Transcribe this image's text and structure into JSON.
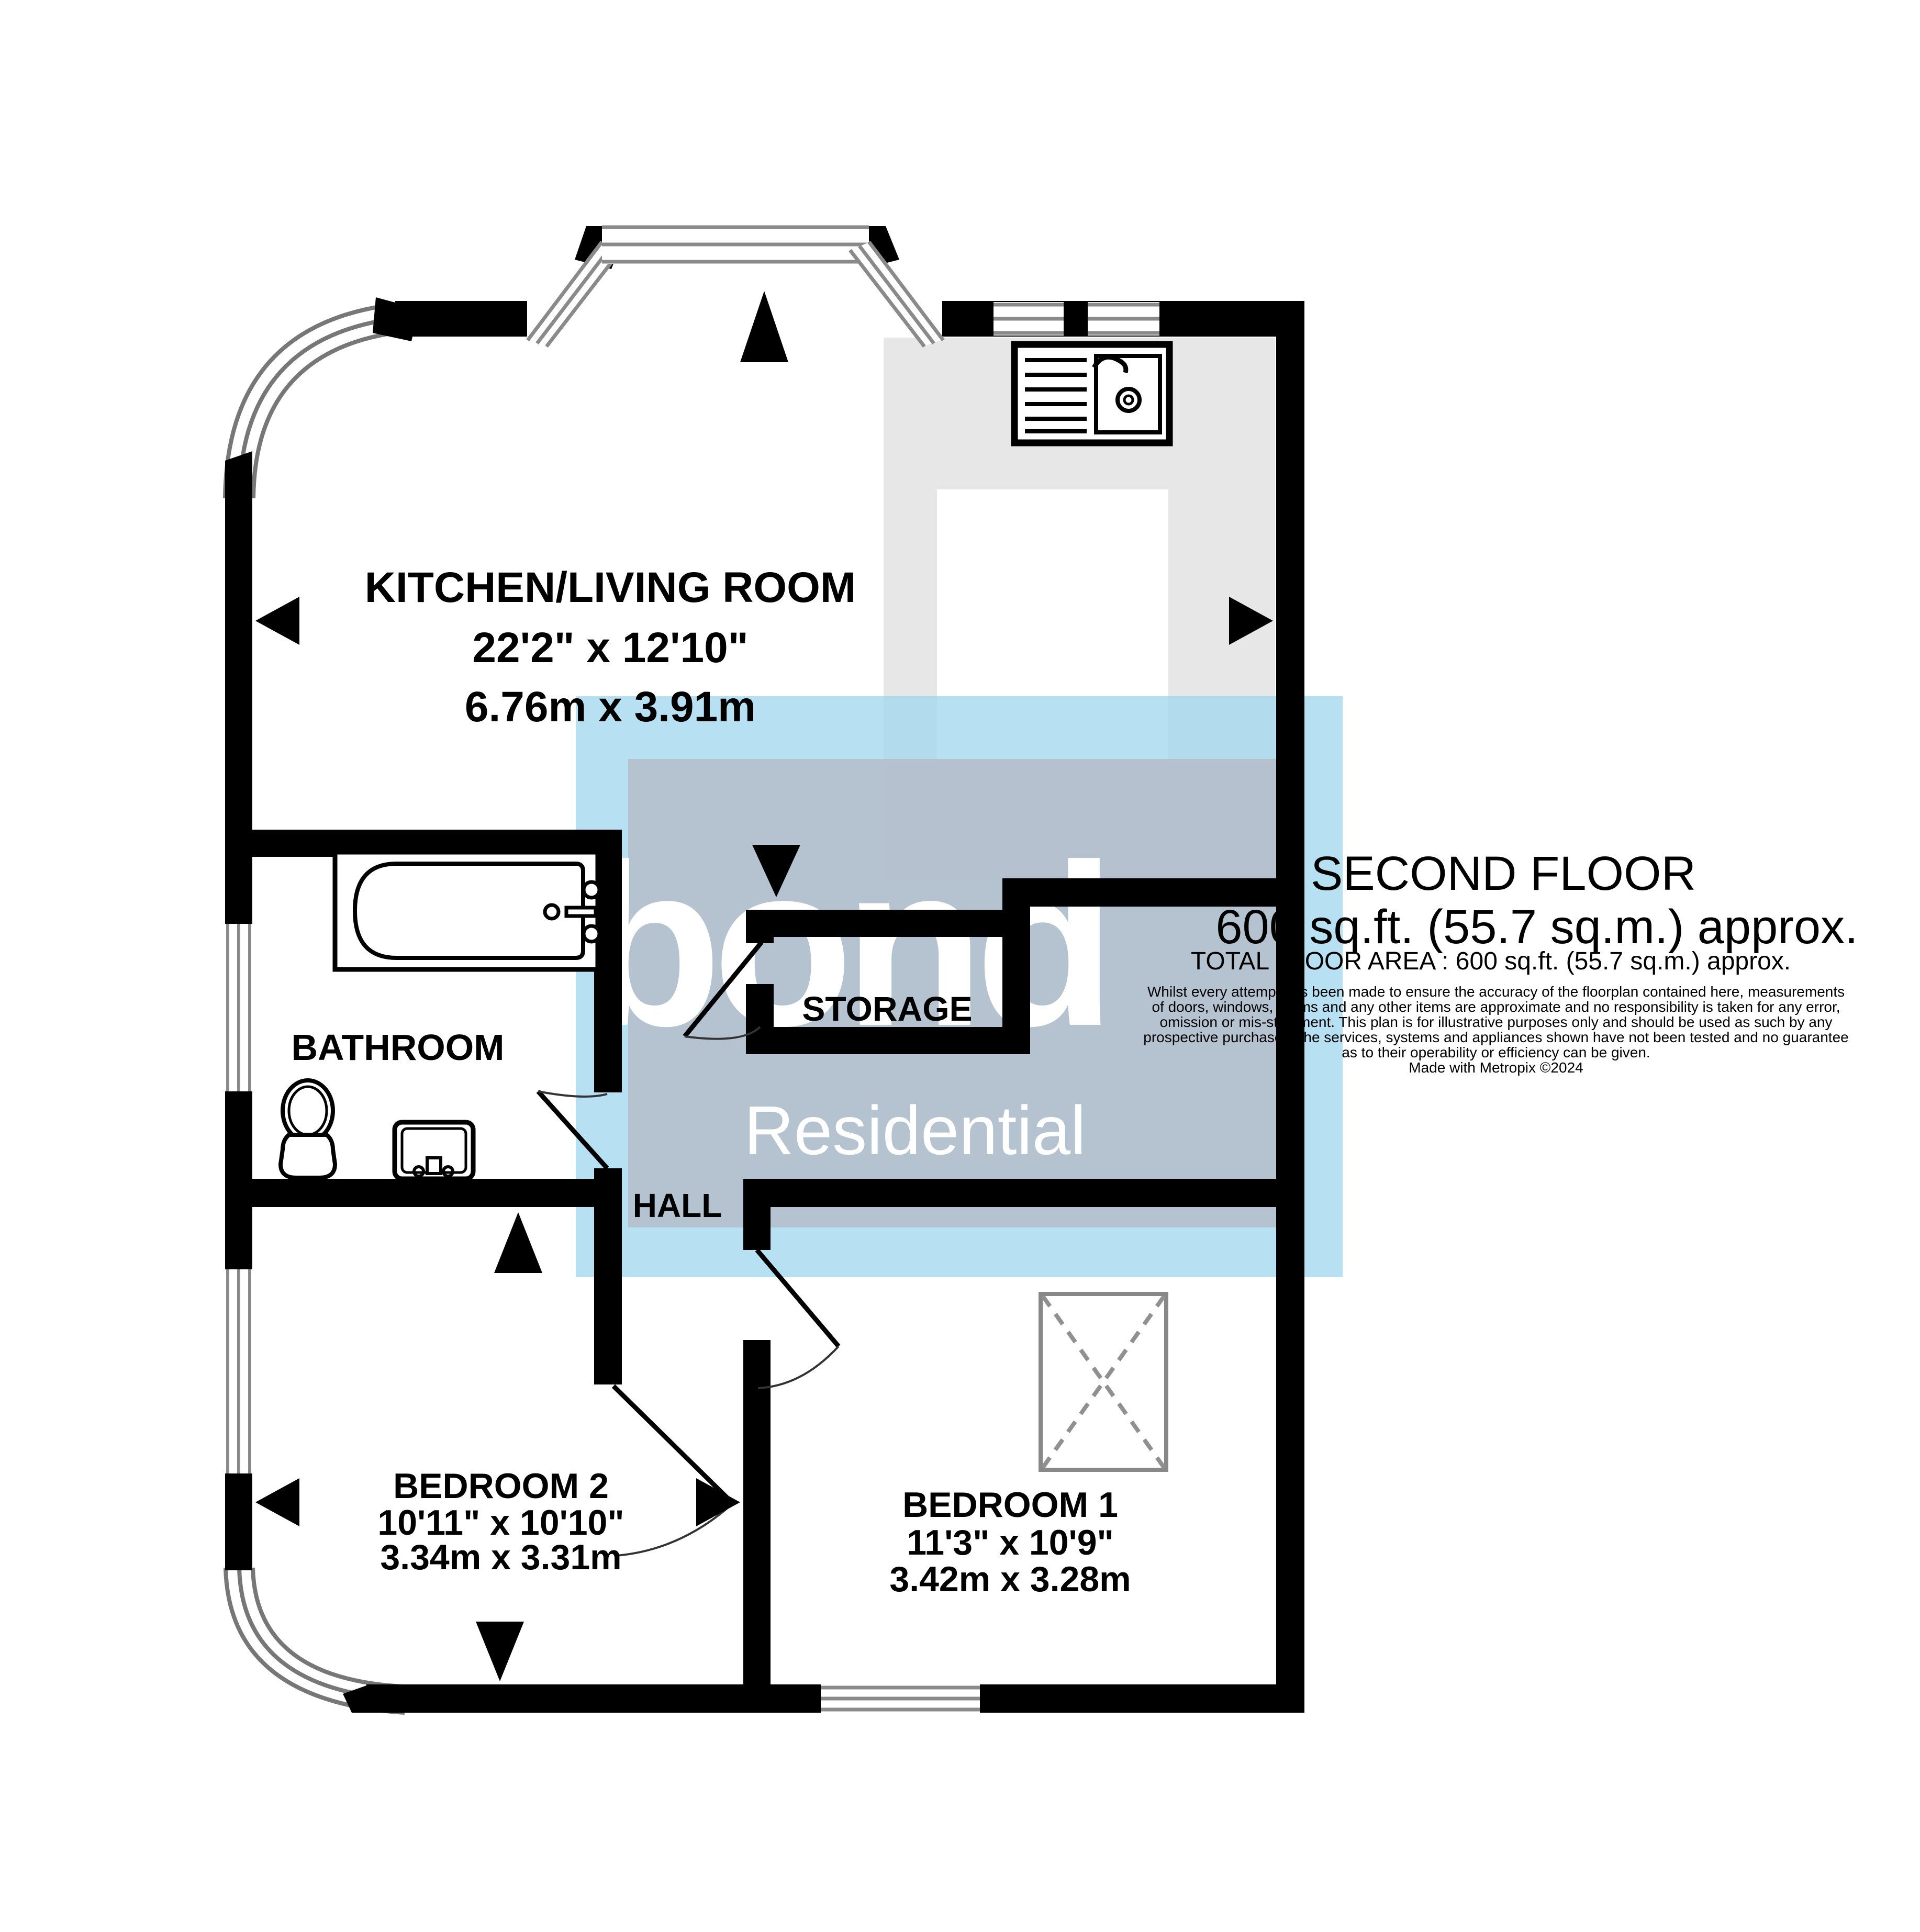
{
  "summary": {
    "floor_title": "SECOND FLOOR",
    "floor_area": "600 sq.ft. (55.7 sq.m.) approx.",
    "total_area": "TOTAL FLOOR AREA : 600 sq.ft. (55.7 sq.m.) approx."
  },
  "rooms": {
    "kitchen": {
      "name": "KITCHEN/LIVING ROOM",
      "imperial": "22'2\" x 12'10\"",
      "metric": "6.76m x 3.91m"
    },
    "bathroom": {
      "name": "BATHROOM"
    },
    "storage": {
      "name": "STORAGE"
    },
    "hall": {
      "name": "HALL"
    },
    "bedroom2": {
      "name": "BEDROOM 2",
      "imperial": "10'11\" x 10'10\"",
      "metric": "3.34m x 3.31m"
    },
    "bedroom1": {
      "name": "BEDROOM 1",
      "imperial": "11'3\" x 10'9\"",
      "metric": "3.42m x 3.28m"
    }
  },
  "watermark": {
    "brand": "bond",
    "tagline": "Residential"
  },
  "disclaimer": {
    "line1": "Whilst every attempt has been made to ensure the accuracy of the floorplan contained here, measurements",
    "line2": "of doors, windows, rooms and any other items are approximate and no responsibility is taken for any error,",
    "line3": "omission or mis-statement. This plan is for illustrative purposes only and should be used as such by any",
    "line4": "prospective purchaser. The services, systems and appliances shown have not been tested and no guarantee",
    "line5": "as to their operability or efficiency can be given.",
    "credit": "Made with Metropix ©2024"
  },
  "fixtures": [
    "bathtub",
    "toilet",
    "wash-basin",
    "kitchen-sink-drainer",
    "wardrobe-x-box"
  ],
  "colors": {
    "wall": "#000000",
    "counter_grey": "#e7e7e7",
    "watermark_blue": "#a5d8ef",
    "watermark_grey": "#b5bdca",
    "window_line": "#8a8a8a",
    "dashed_grey": "#909090"
  }
}
